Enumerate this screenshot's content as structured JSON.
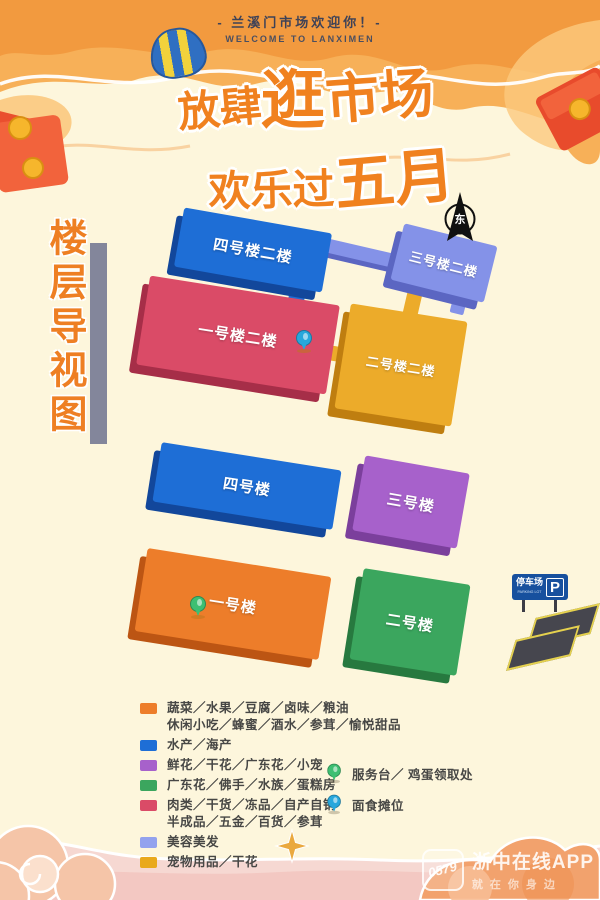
{
  "header": {
    "welcome_cn": "- 兰溪门市场欢迎你！-",
    "welcome_en": "WELCOME TO LANXIMEN"
  },
  "title": {
    "l1a": "放肆",
    "l1b": "逛",
    "l1c": "市场",
    "l2a": "欢乐过",
    "l2b": "五月",
    "color": "#f0811f"
  },
  "side_title": {
    "text": "楼层导视图",
    "color": "#ee7f23"
  },
  "compass": {
    "label": "东"
  },
  "map": {
    "buildings": [
      {
        "name": "building-4-floor-2",
        "label": "四号楼二楼",
        "color": "#1e6ed6"
      },
      {
        "name": "building-3-floor-2",
        "label": "三号楼二楼",
        "color": "#8492e8"
      },
      {
        "name": "building-1-floor-2",
        "label": "一号楼二楼",
        "color": "#da4b67"
      },
      {
        "name": "building-2-floor-2",
        "label": "二号楼二楼",
        "color": "#ecab2a"
      },
      {
        "name": "building-4",
        "label": "四号楼",
        "color": "#1e6ed6"
      },
      {
        "name": "building-3",
        "label": "三号楼",
        "color": "#a761cb"
      },
      {
        "name": "building-1",
        "label": "一号楼",
        "color": "#ed7d2a"
      },
      {
        "name": "building-2",
        "label": "二号楼",
        "color": "#3ba65e"
      }
    ],
    "parking": {
      "sign_cn": "停车场",
      "sign_en": "PARKING LOT",
      "sign_p": "P"
    },
    "pins": [
      {
        "color": "#28a7dc",
        "on": "building-1-floor-2"
      },
      {
        "color": "#3dbf72",
        "on": "building-1"
      }
    ]
  },
  "legend": {
    "items": [
      {
        "color": "#ed7d2a",
        "lines": [
          "蔬菜／水果／豆腐／卤味／粮油",
          "休闲小吃／蜂蜜／酒水／参茸／愉悦甜品"
        ]
      },
      {
        "color": "#1e6ed6",
        "lines": [
          "水产／海产"
        ]
      },
      {
        "color": "#a761cb",
        "lines": [
          "鲜花／干花／广东花／小宠"
        ]
      },
      {
        "color": "#3ba65e",
        "lines": [
          "广东花／佛手／水族／蛋糕房"
        ]
      },
      {
        "color": "#da4b67",
        "lines": [
          "肉类／干货／冻品／自产自销",
          "半成品／五金／百货／参茸"
        ]
      },
      {
        "color": "#93a2ee",
        "lines": [
          "美容美发"
        ]
      },
      {
        "color": "#e9a91c",
        "lines": [
          "宠物用品／干花"
        ]
      }
    ],
    "markers": [
      {
        "color": "#3dbf72",
        "label": "服务台／ 鸡蛋领取处"
      },
      {
        "color": "#28a7dc",
        "label": "面食摊位"
      }
    ]
  },
  "watermark": {
    "badge": "0579",
    "line1": "浙中在线APP",
    "line2": "就在你身边"
  }
}
